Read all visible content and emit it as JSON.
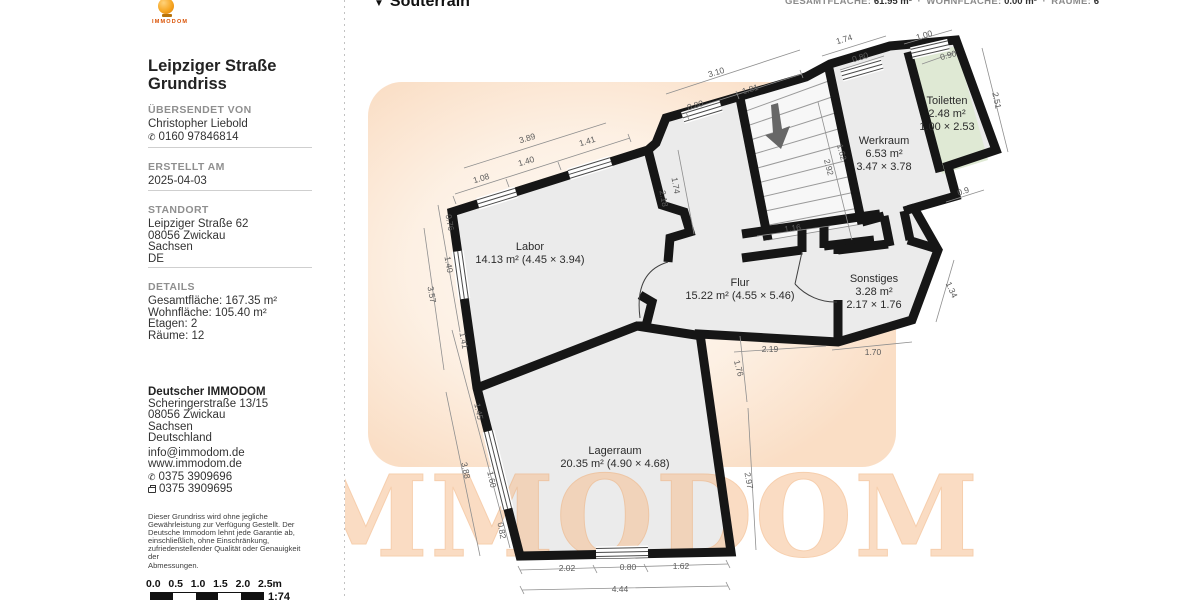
{
  "header": {
    "floor_label": "Souterrain",
    "dropdown_icon": "▼",
    "separator": "·",
    "stats": [
      {
        "label": "GESAMTFLÄCHE:",
        "value": "61.95 m²"
      },
      {
        "label": "WOHNFLÄCHE:",
        "value": "0.00 m²"
      },
      {
        "label": "RÄUME:",
        "value": "6"
      }
    ]
  },
  "sidebar": {
    "logo_word": "IMMODOM",
    "title_line1": "Leipziger Straße",
    "title_line2": "Grundriss",
    "uebersendet": {
      "header": "ÜBERSENDET VON",
      "name": "Christopher Liebold",
      "phone": "0160 97846814"
    },
    "erstellt": {
      "header": "ERSTELLT AM",
      "date": "2025-04-03"
    },
    "standort": {
      "header": "STANDORT",
      "lines": [
        "Leipziger Straße 62",
        "08056 Zwickau",
        "Sachsen",
        "DE"
      ]
    },
    "details": {
      "header": "DETAILS",
      "lines": [
        "Gesamtfläche: 167.35 m²",
        "Wohnfläche: 105.40 m²",
        "Etagen: 2",
        "Räume: 12"
      ]
    },
    "company": {
      "name": "Deutscher IMMODOM",
      "lines": [
        "Scheringerstraße 13/15",
        "08056 Zwickau",
        "Sachsen",
        "Deutschland"
      ],
      "email": "info@immodom.de",
      "website": "www.immodom.de",
      "phone": "0375 3909696",
      "fax": "0375 3909695"
    },
    "disclaimer": "Dieser Grundriss wird ohne jegliche\nGewährleistung zur Verfügung Gestellt. Der\nDeutsche Immodom lehnt jede Garantie ab,\neinschließlich, ohne Einschränkung,\nzufriedenstellender Qualität oder Genauigkeit der\nAbmessungen.",
    "scale": {
      "labels": [
        "0.0",
        "0.5",
        "1.0",
        "1.5",
        "2.0",
        "2.5m"
      ],
      "ratio": "1:74"
    }
  },
  "floor_plan": {
    "watermark": "IMMODOM",
    "colors": {
      "wall": "#161616",
      "room_fill": "#ebebeb",
      "toilet_fill": "#dfe9d4",
      "accent": "#f59b00"
    },
    "rooms": [
      {
        "id": "labor",
        "x": 530,
        "y": 250,
        "lines": [
          "Labor",
          "14.13 m² (4.45 × 3.94)"
        ]
      },
      {
        "id": "flur",
        "x": 740,
        "y": 286,
        "lines": [
          "Flur",
          "15.22 m² (4.55 × 5.46)"
        ]
      },
      {
        "id": "werkraum",
        "x": 884,
        "y": 144,
        "lines": [
          "Werkraum",
          "6.53 m²",
          "3.47 × 3.78"
        ]
      },
      {
        "id": "toiletten",
        "x": 947,
        "y": 104,
        "lines": [
          "Toiletten",
          "2.48 m²",
          "1.00 × 2.53"
        ]
      },
      {
        "id": "sonstiges",
        "x": 874,
        "y": 282,
        "lines": [
          "Sonstiges",
          "3.28 m²",
          "2.17 × 1.76"
        ]
      },
      {
        "id": "lagerraum",
        "x": 615,
        "y": 454,
        "lines": [
          "Lagerraum",
          "20.35 m² (4.90 × 4.68)"
        ]
      }
    ],
    "dimensions": [
      {
        "t": "3.89",
        "x": 528,
        "y": 141,
        "r": -17
      },
      {
        "t": "1.41",
        "x": 588,
        "y": 144,
        "r": -17
      },
      {
        "t": "1.40",
        "x": 527,
        "y": 164,
        "r": -17
      },
      {
        "t": "1.08",
        "x": 482,
        "y": 181,
        "r": -17
      },
      {
        "t": "0.76",
        "x": 447,
        "y": 223,
        "r": 80
      },
      {
        "t": "1.40",
        "x": 446,
        "y": 265,
        "r": 80
      },
      {
        "t": "3.57",
        "x": 429,
        "y": 295,
        "r": 80
      },
      {
        "t": "1.41",
        "x": 461,
        "y": 341,
        "r": 80
      },
      {
        "t": "1.45",
        "x": 476,
        "y": 412,
        "r": 78
      },
      {
        "t": "3.88",
        "x": 463,
        "y": 471,
        "r": 78
      },
      {
        "t": "1.60",
        "x": 489,
        "y": 480,
        "r": 78
      },
      {
        "t": "0.82",
        "x": 499,
        "y": 531,
        "r": 80
      },
      {
        "t": "2.02",
        "x": 567,
        "y": 571,
        "r": 0
      },
      {
        "t": "0.80",
        "x": 628,
        "y": 570,
        "r": 0
      },
      {
        "t": "1.62",
        "x": 681,
        "y": 569,
        "r": 0
      },
      {
        "t": "4.44",
        "x": 620,
        "y": 592,
        "r": 0
      },
      {
        "t": "1.76",
        "x": 736,
        "y": 369,
        "r": 75
      },
      {
        "t": "2.97",
        "x": 746,
        "y": 481,
        "r": 80
      },
      {
        "t": "2.19",
        "x": 770,
        "y": 352,
        "r": 0
      },
      {
        "t": "1.70",
        "x": 873,
        "y": 355,
        "r": 0
      },
      {
        "t": "1.34",
        "x": 949,
        "y": 291,
        "r": 65
      },
      {
        "t": "1.16",
        "x": 793,
        "y": 231,
        "r": -8
      },
      {
        "t": "2.18",
        "x": 661,
        "y": 199,
        "r": 80
      },
      {
        "t": "1.74",
        "x": 673,
        "y": 186,
        "r": 80
      },
      {
        "t": "2.92",
        "x": 826,
        "y": 168,
        "r": 75
      },
      {
        "t": "1.62",
        "x": 839,
        "y": 153,
        "r": 75
      },
      {
        "t": "3.10",
        "x": 717,
        "y": 75,
        "r": -17
      },
      {
        "t": "1.81",
        "x": 751,
        "y": 92,
        "r": -17
      },
      {
        "t": "0.80",
        "x": 696,
        "y": 108,
        "r": -17
      },
      {
        "t": "1.74",
        "x": 845,
        "y": 42,
        "r": -17
      },
      {
        "t": "0.80",
        "x": 861,
        "y": 60,
        "r": -17
      },
      {
        "t": "1.00",
        "x": 925,
        "y": 38,
        "r": -17
      },
      {
        "t": "0.90",
        "x": 949,
        "y": 58,
        "r": -15
      },
      {
        "t": "2.51",
        "x": 994,
        "y": 101,
        "r": 78
      },
      {
        "t": "0.9",
        "x": 964,
        "y": 194,
        "r": -17
      }
    ]
  }
}
